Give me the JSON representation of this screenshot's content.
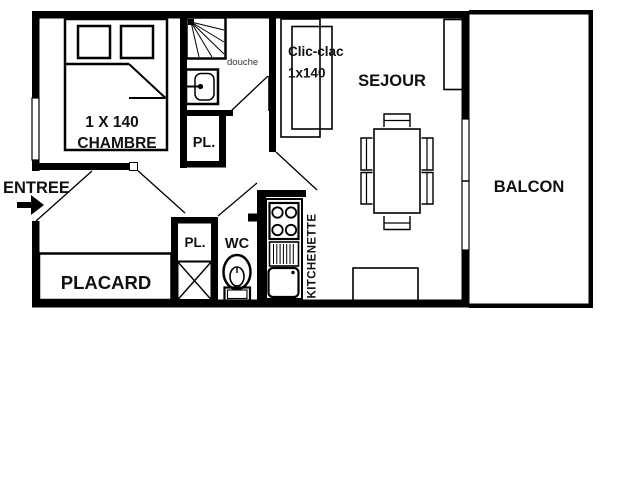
{
  "plan": {
    "rooms": {
      "entree": {
        "label": "ENTREE"
      },
      "chambre": {
        "label": "CHAMBRE",
        "bed_label": "1 X 140"
      },
      "douche": {
        "label": "douche"
      },
      "closet_upper": {
        "label": "PL."
      },
      "placard": {
        "label": "PLACARD"
      },
      "closet_lower": {
        "label": "PL."
      },
      "wc": {
        "label": "WC"
      },
      "kitchenette": {
        "label": "KITCHENETTE"
      },
      "sejour": {
        "label": "SEJOUR",
        "sofa_label_line1": "Clic-clac",
        "sofa_label_line2": "1x140"
      },
      "balcon": {
        "label": "BALCON"
      }
    },
    "colors": {
      "wall": "#000000",
      "background": "#ffffff",
      "text": "#111111",
      "secondary_text": "#333333"
    }
  }
}
